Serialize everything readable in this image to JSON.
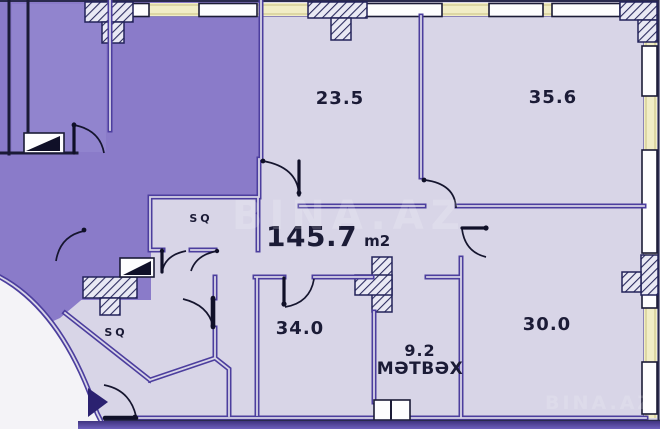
{
  "plan": {
    "title": "apartment-floor-plan",
    "watermark": "BINA.AZ",
    "total": {
      "area": "145.7",
      "unit": "m2"
    },
    "rooms": [
      {
        "key": "room-top-left",
        "label": "23.5"
      },
      {
        "key": "room-top-right",
        "label": "35.6"
      },
      {
        "key": "room-bottom-left",
        "label": "34.0"
      },
      {
        "key": "room-bottom-right",
        "label": "30.0"
      },
      {
        "key": "kitchen",
        "label": "9.2",
        "name": "MƏTBƏX"
      },
      {
        "key": "sq-upper",
        "label": "SQ"
      },
      {
        "key": "sq-lower",
        "label": "SQ"
      }
    ],
    "colors": {
      "room_fill": "#d8d5e7",
      "adjacent_fill": "#8a7bc9",
      "wall_purple": "#4c3e9e",
      "outline_dark": "#1b1b36",
      "exterior_band": "#f1edc6",
      "window_fill": "#fdfdfe",
      "bottom_band_dark": "#3f3380",
      "bottom_band_light": "#6e60bd",
      "arrow": "#2b2170",
      "outside_white": "#f4f3f7"
    }
  }
}
